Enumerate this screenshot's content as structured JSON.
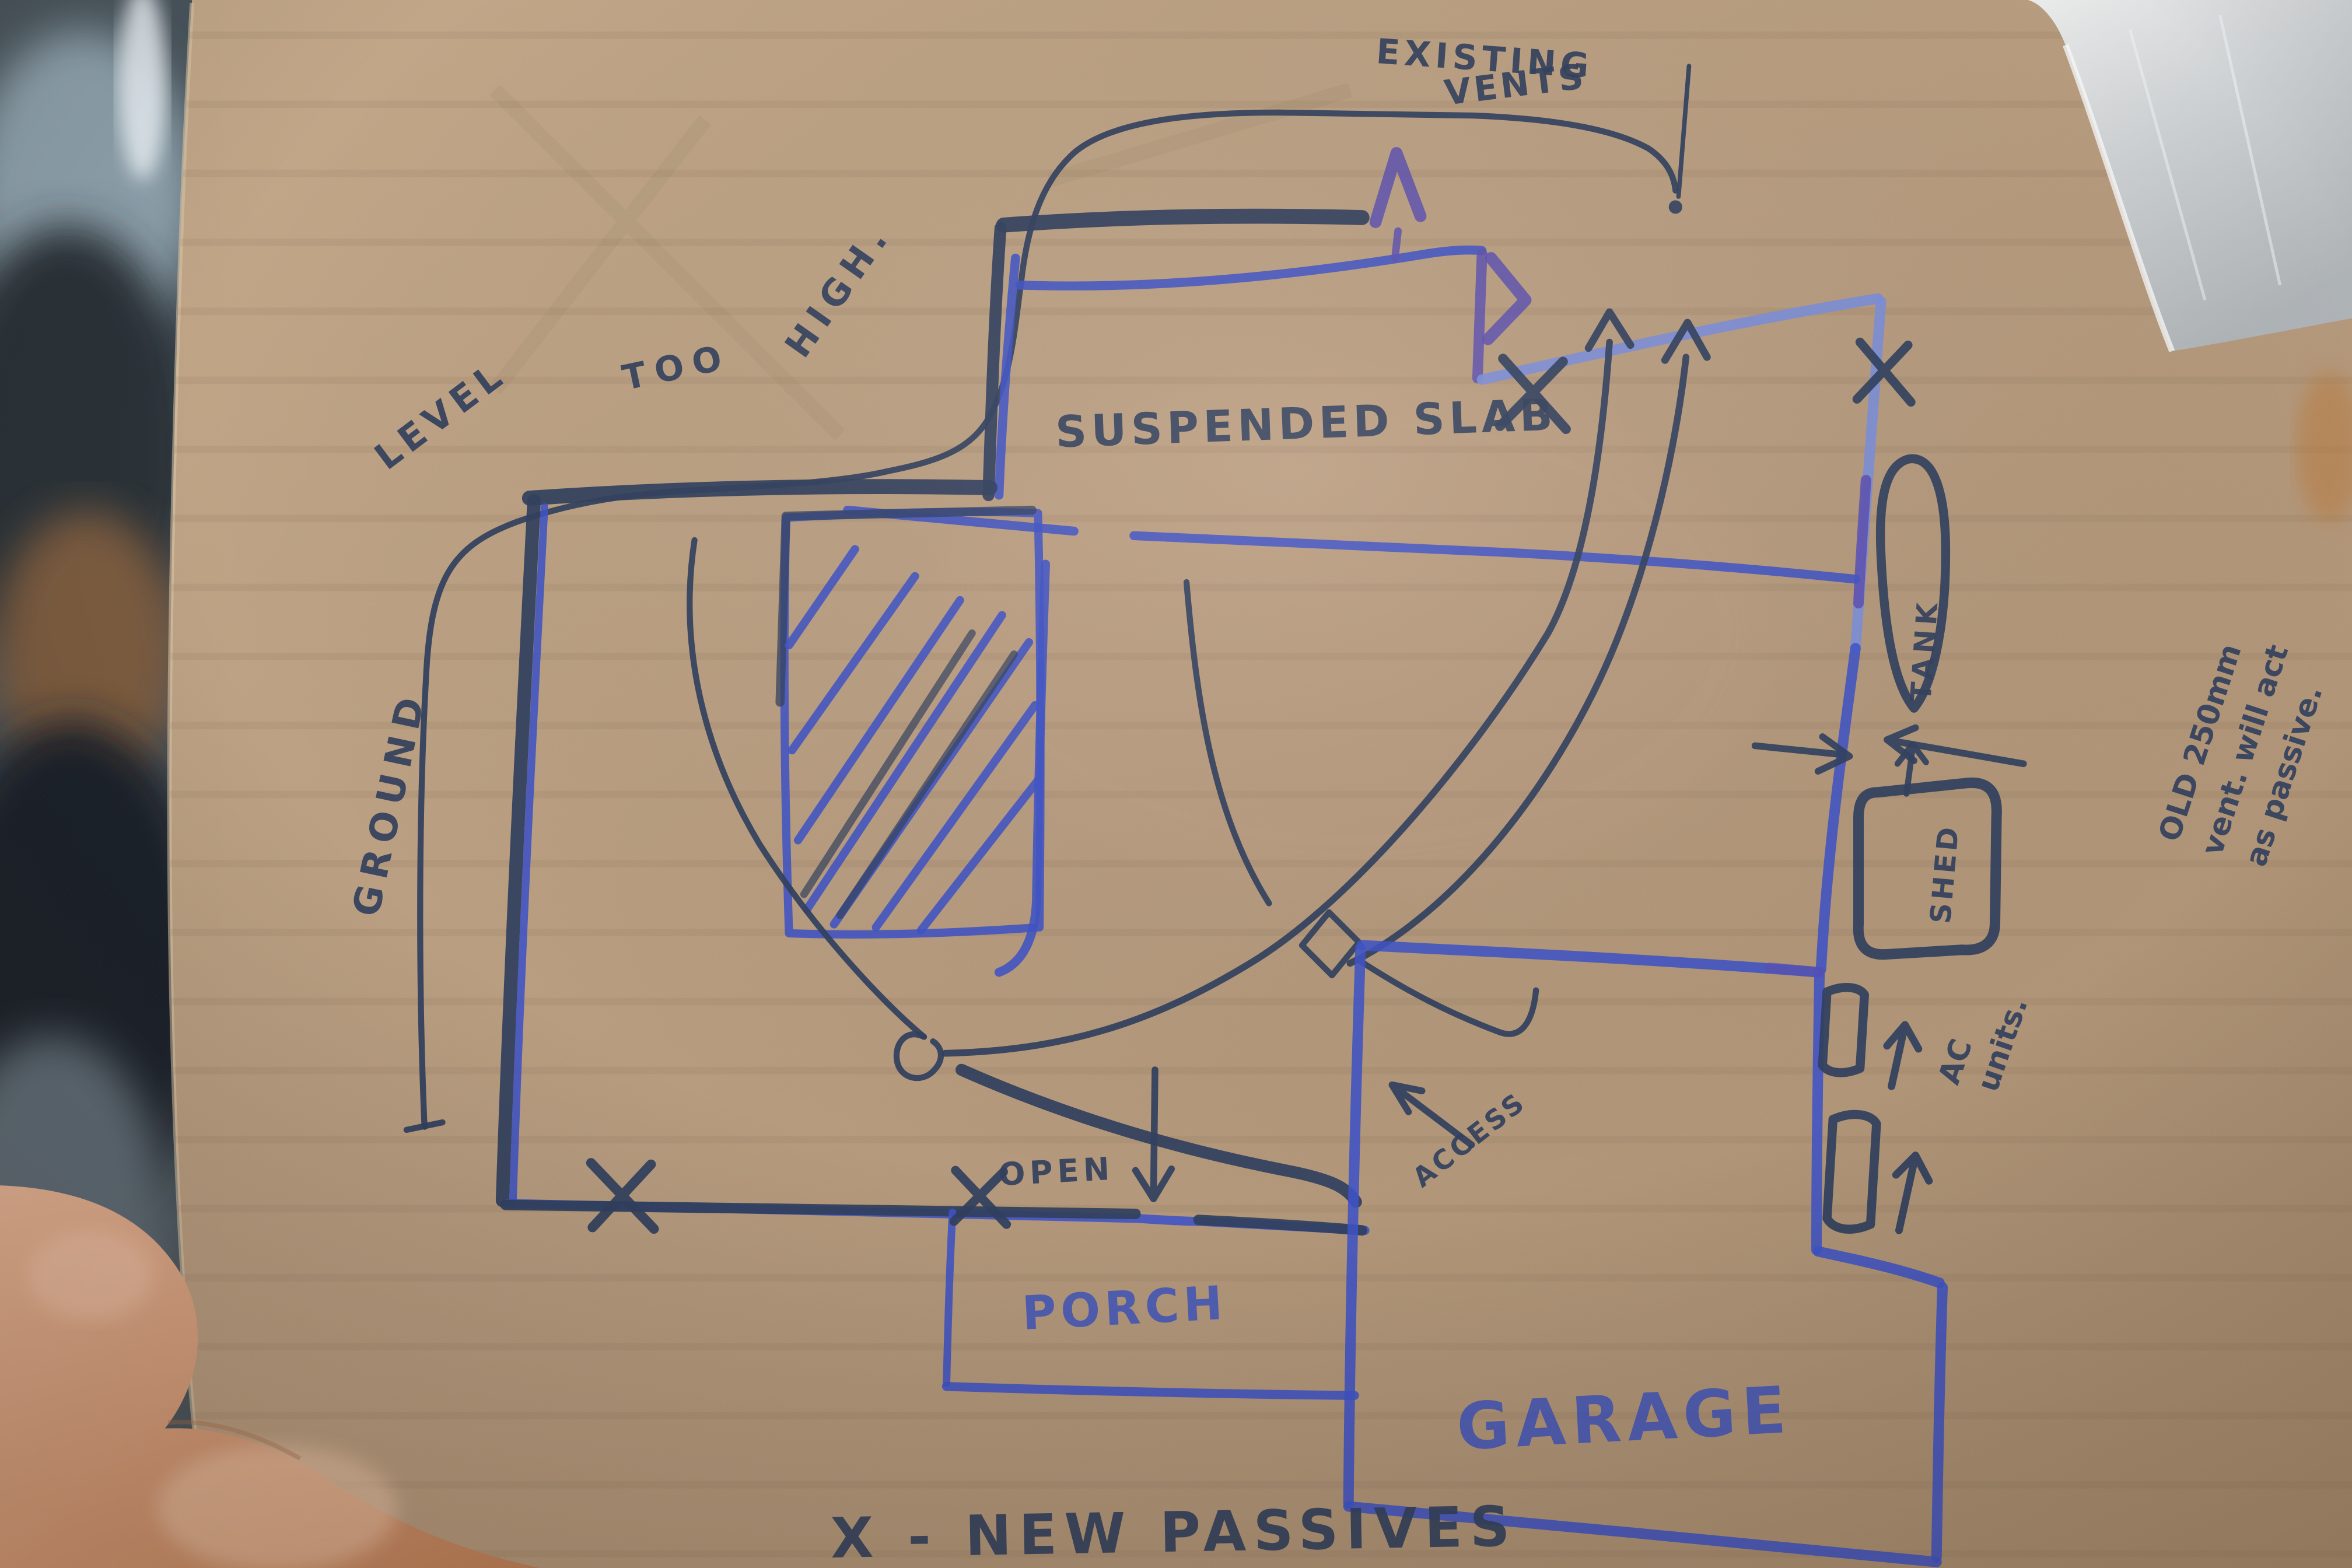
{
  "photo": {
    "description": "Hand-drawn house ventilation floor-plan sketched with blue and navy markers on a piece of cardboard, held by a hand at bottom-left, silver tape on the top-right corner",
    "surface": "cardboard"
  },
  "annotations": {
    "existing_vents": {
      "line1": "EXISTING",
      "line2": "VENTS"
    },
    "ground_level": {
      "word1": "GROUND",
      "word2": "LEVEL",
      "word3": "TOO",
      "word4": "HIGH."
    },
    "suspended_slab": "SUSPENDED SLAB",
    "tank": "TANK",
    "old_vent_note": [
      "OLD 250mm",
      "vent. will act",
      "as passive."
    ],
    "shed": "SHED",
    "ac_units": [
      "AC",
      "units."
    ],
    "access": "ACCESS",
    "open": "OPEN",
    "porch": "PORCH",
    "garage": "GARAGE",
    "legend": "X - NEW PASSIVES"
  },
  "symbols": {
    "x_mark_count": 4,
    "up_chevron": "^",
    "right_chevron": ">"
  },
  "colors": {
    "cardboard": "#b59a7d",
    "marker_dark_navy": "#32415f",
    "marker_blue": "#3f53c6",
    "marker_light_blue": "#7b8ed9",
    "marker_purple": "#5c50b0",
    "tape_silver": "#d7dbde",
    "skin": "#d8a184"
  }
}
